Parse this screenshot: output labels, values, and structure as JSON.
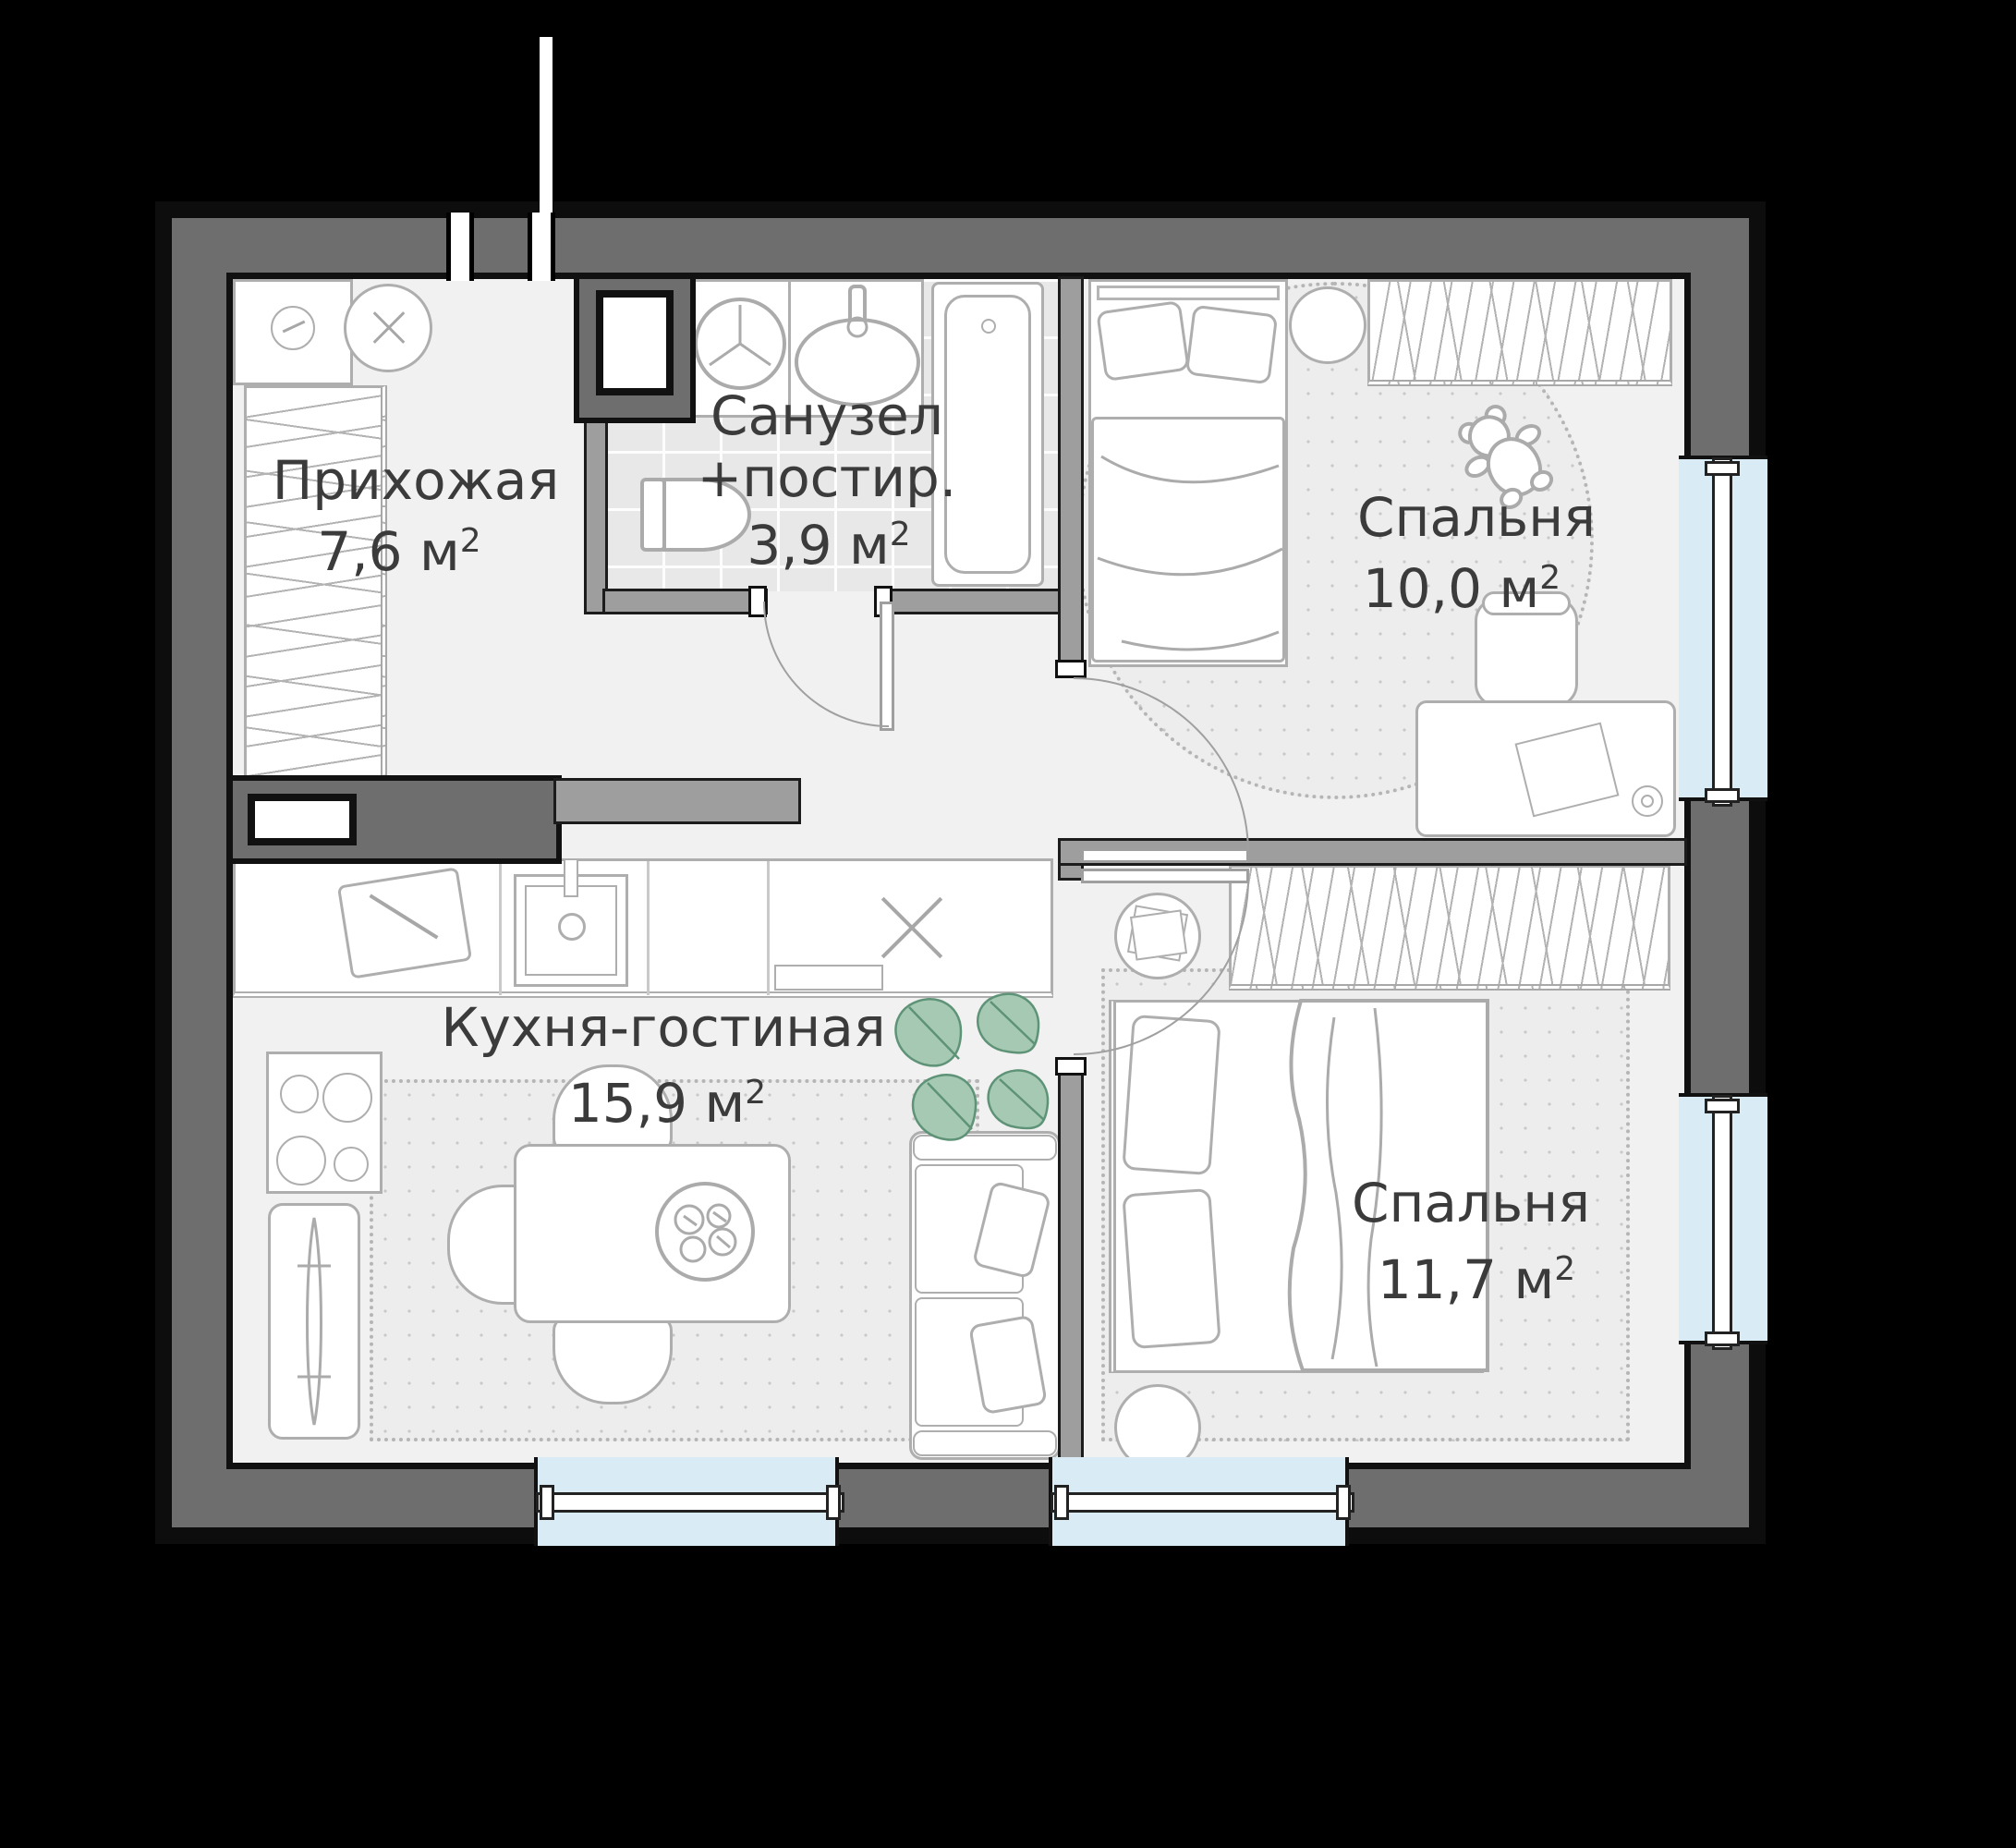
{
  "plan_title": "apartment-floor-plan",
  "rooms": {
    "hallway": {
      "name": "Прихожая",
      "area": "7,6 м",
      "area_sup": "2"
    },
    "bathroom": {
      "name_line1": "Санузел",
      "name_line2": "+постир.",
      "area": "3,9 м",
      "area_sup": "2"
    },
    "bedroom1": {
      "name": "Спальня",
      "area": "10,0 м",
      "area_sup": "2"
    },
    "living": {
      "name": "Кухня-гостиная",
      "area": "15,9 м",
      "area_sup": "2"
    },
    "bedroom2": {
      "name": "Спальня",
      "area": "11,7 м",
      "area_sup": "2"
    }
  },
  "fixtures": [
    "entry-opening",
    "wardrobe",
    "pouf",
    "shoe-cabinet",
    "ventilation-shaft",
    "washing-machine",
    "bathroom-sink",
    "bathtub",
    "toilet",
    "kitchen-counter",
    "kitchen-sink",
    "cutting-board",
    "appliance-slot-x",
    "stove",
    "radiator",
    "dining-table",
    "plate-with-food",
    "chairs",
    "sofa",
    "monstera-plant",
    "double-bed",
    "single-bed",
    "nightstand",
    "desk",
    "desk-chair",
    "teddy-bear",
    "round-rug",
    "rug",
    "windows",
    "interior-doors"
  ],
  "colors": {
    "background": "#000000",
    "wall_outer": "#6e6e6e",
    "wall_inner": "#9e9e9e",
    "floor": "#f1f1f1",
    "tile": "#e8e8e8",
    "window_glass": "#d9ecf5",
    "furniture_line": "#aeaeae",
    "rug_line": "#b5b5b5",
    "text": "#3b3b3b",
    "plant_fill": "#a6c9b3",
    "plant_stroke": "#5e9377"
  }
}
